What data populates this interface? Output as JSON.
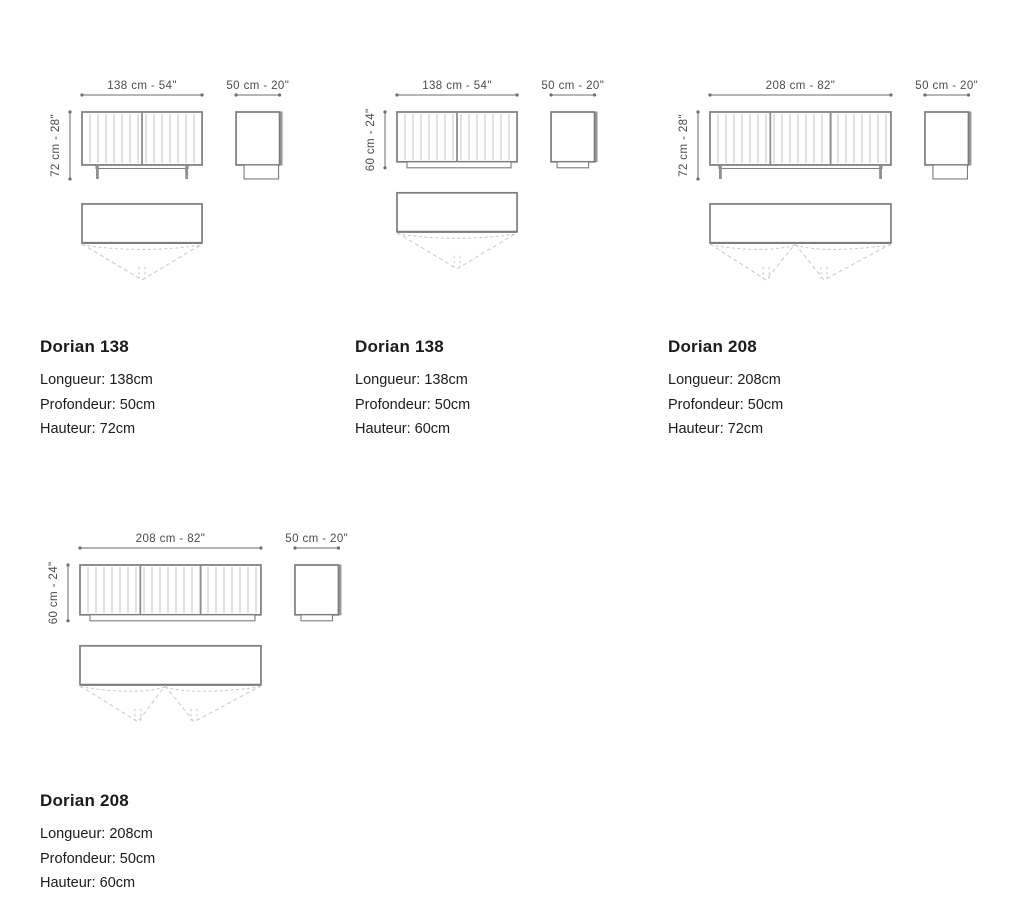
{
  "page": {
    "background": "#ffffff"
  },
  "colors": {
    "outline": "#7d7d7d",
    "slat": "#c6c6c6",
    "divider": "#8d8d8d",
    "shade": "#9b9b9b",
    "leg": "#8f8f8f",
    "arc": "#c9c9c9",
    "dim_line": "#6e6e6e",
    "dim_text": "#4b4b4b",
    "text": "#1b1b1b"
  },
  "products": [
    {
      "name": "Dorian 138",
      "specs": {
        "longueur": "Longueur: 138cm",
        "profondeur": "Profondeur: 50cm",
        "hauteur": "Hauteur: 72cm"
      },
      "diagram": {
        "width_label": "138 cm - 54\"",
        "depth_label": "50 cm - 20\"",
        "height_label": "72 cm - 28\"",
        "width_cm": 138,
        "depth_cm": 50,
        "height_cm": 72,
        "base": "legs",
        "sections": 2,
        "doors": [
          {
            "from": 0,
            "apex": 0.5,
            "to": 1
          }
        ]
      }
    },
    {
      "name": "Dorian 138",
      "specs": {
        "longueur": "Longueur: 138cm",
        "profondeur": "Profondeur: 50cm",
        "hauteur": "Hauteur: 60cm"
      },
      "diagram": {
        "width_label": "138 cm - 54\"",
        "depth_label": "50 cm - 20\"",
        "height_label": "60 cm - 24\"",
        "width_cm": 138,
        "depth_cm": 50,
        "height_cm": 60,
        "base": "plinth",
        "sections": 2,
        "doors": [
          {
            "from": 0,
            "apex": 0.5,
            "to": 1
          }
        ]
      }
    },
    {
      "name": "Dorian 208",
      "specs": {
        "longueur": "Longueur: 208cm",
        "profondeur": "Profondeur: 50cm",
        "hauteur": "Hauteur: 72cm"
      },
      "diagram": {
        "width_label": "208 cm - 82\"",
        "depth_label": "50 cm - 20\"",
        "height_label": "72 cm - 28\"",
        "width_cm": 208,
        "depth_cm": 50,
        "height_cm": 72,
        "base": "legs",
        "sections": 3,
        "doors": [
          {
            "from": 0,
            "apex": 0.31,
            "to": 0.47
          },
          {
            "from": 0.47,
            "apex": 0.63,
            "to": 1
          }
        ]
      }
    },
    {
      "name": "Dorian 208",
      "specs": {
        "longueur": "Longueur: 208cm",
        "profondeur": "Profondeur: 50cm",
        "hauteur": "Hauteur: 60cm"
      },
      "diagram": {
        "width_label": "208 cm - 82\"",
        "depth_label": "50 cm - 20\"",
        "height_label": "60 cm - 24\"",
        "width_cm": 208,
        "depth_cm": 50,
        "height_cm": 60,
        "base": "plinth",
        "sections": 3,
        "doors": [
          {
            "from": 0,
            "apex": 0.32,
            "to": 0.47
          },
          {
            "from": 0.47,
            "apex": 0.63,
            "to": 1
          }
        ]
      }
    }
  ]
}
